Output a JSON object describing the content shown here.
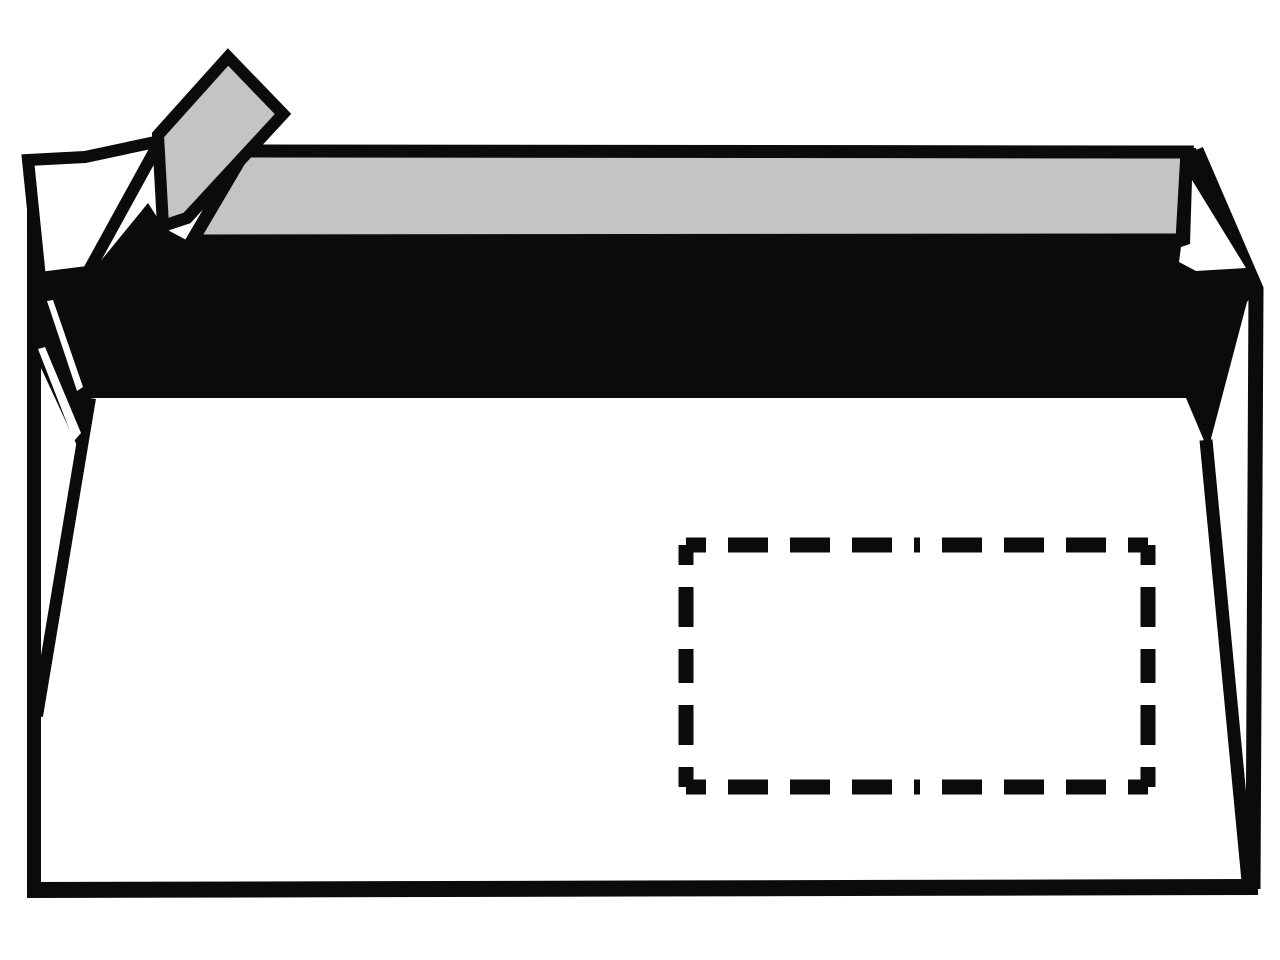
{
  "canvas": {
    "width": 1280,
    "height": 960,
    "background": "#ffffff"
  },
  "palette": {
    "ink": "#0b0b0b",
    "liner": "#c4c4c4",
    "paper": "#ffffff"
  },
  "illustration": {
    "alt": "Line drawing of a windowed envelope, back side, with self-adhesive seal strip and peel-off liner partially removed"
  },
  "shapes": [
    {
      "id": "outer-left-edge",
      "type": "line",
      "x1": 34,
      "y1": 158,
      "x2": 34,
      "y2": 889,
      "stroke": "ink",
      "width": 14
    },
    {
      "id": "bottom-edge",
      "type": "line",
      "x1": 27,
      "y1": 890,
      "x2": 1258,
      "y2": 887,
      "stroke": "ink",
      "width": 16
    },
    {
      "id": "outer-right-edge",
      "type": "polyline",
      "points": "1196,150 1256,289 1253,889",
      "stroke": "ink",
      "width": 15
    },
    {
      "id": "body-left-fold",
      "type": "line",
      "x1": 90,
      "y1": 398,
      "x2": 37,
      "y2": 716,
      "stroke": "ink",
      "width": 12
    },
    {
      "id": "body-right-fold",
      "type": "line",
      "x1": 1206,
      "y1": 440,
      "x2": 1248,
      "y2": 881,
      "stroke": "ink",
      "width": 13
    },
    {
      "id": "flap-face",
      "type": "polygon",
      "points": "190,242 245,150 1196,148 1256,290 1247,302 1208,450 1186,398 88,398 80,452 35,355 38,281 90,274 148,203 164,228",
      "fill": "ink"
    },
    {
      "id": "adhesive-strip",
      "type": "polygon",
      "points": "245,151 1187,152 1182,240 192,241",
      "fill": "liner",
      "stroke": "ink",
      "width": 13
    },
    {
      "id": "flap-tip",
      "type": "polygon",
      "points": "28,160 85,157 160,141 88,272 40,278",
      "fill": "paper",
      "stroke": "ink",
      "width": 12
    },
    {
      "id": "liner-strip",
      "type": "polygon",
      "points": "228,57 283,114 187,218 163,226 158,135",
      "fill": "liner",
      "stroke": "ink",
      "width": 12
    },
    {
      "id": "right-notch",
      "type": "polygon",
      "points": "1192,180 1246,268 1196,271 1179,262 1181,247 1190,244",
      "fill": "paper"
    },
    {
      "id": "seam-sliver-upper",
      "type": "polygon",
      "points": "47,301 53,300 83,387 77,391",
      "fill": "paper"
    },
    {
      "id": "seam-sliver-lower",
      "type": "polygon",
      "points": "38,349 45,347 81,433 74,441",
      "fill": "paper"
    },
    {
      "id": "address-window",
      "type": "dashed-rect",
      "x1": 686,
      "y1": 545,
      "x2": 1148,
      "y2": 787,
      "stroke": "ink",
      "width": 15,
      "dash": 40,
      "gap": 22,
      "offset": 20
    }
  ]
}
